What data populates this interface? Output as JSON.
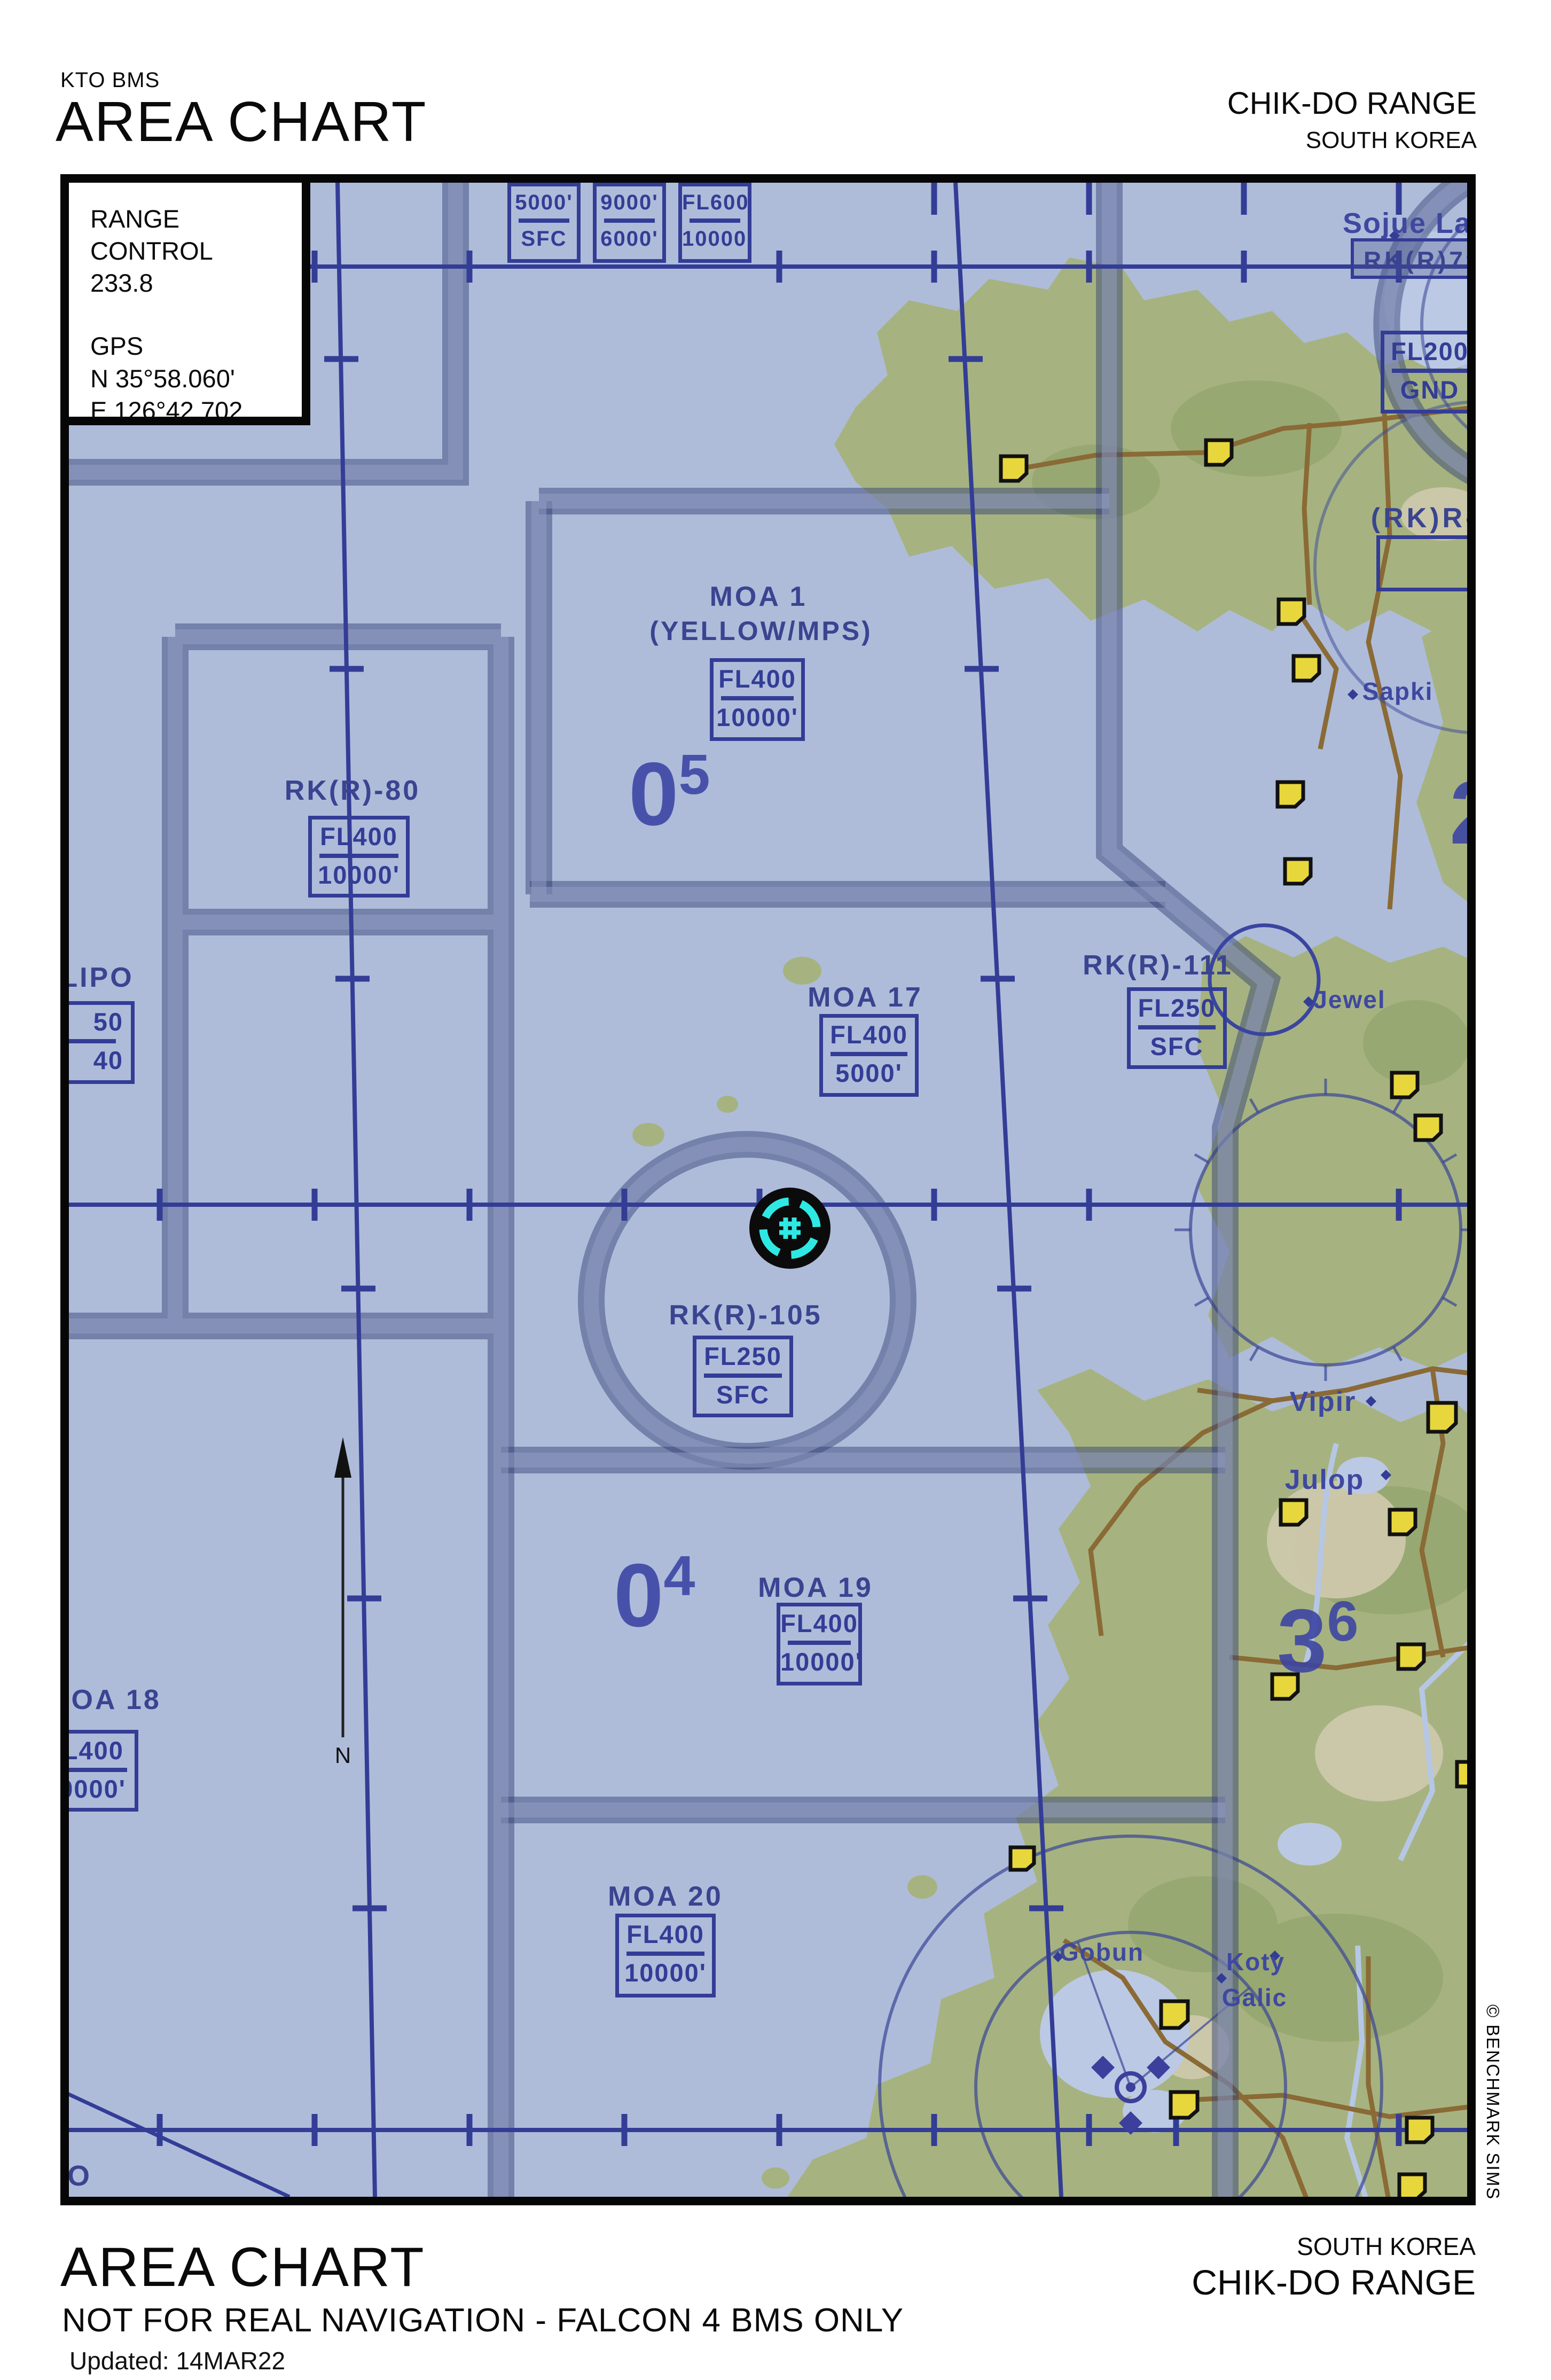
{
  "header": {
    "program": "KTO BMS",
    "title": "AREA CHART",
    "range": "CHIK-DO RANGE",
    "country": "SOUTH KOREA"
  },
  "info_box": {
    "title": "RANGE CONTROL",
    "frequency": "233.8",
    "gps_label": "GPS",
    "lat": "N 35°58.060'",
    "lon": "E  126°42.702"
  },
  "top_altitude_boxes": [
    {
      "upper": "5000'",
      "lower": "SFC"
    },
    {
      "upper": "9000'",
      "lower": "6000'"
    },
    {
      "upper": "FL600",
      "lower": "10000'"
    }
  ],
  "zones": {
    "moa1": {
      "name": "MOA 1",
      "sub": "(YELLOW/MPS)",
      "upper": "FL400",
      "lower": "10000'"
    },
    "moa17": {
      "name": "MOA 17",
      "upper": "FL400",
      "lower": "5000'"
    },
    "moa18": {
      "name": "MOA 18",
      "upper": "FL400",
      "lower": "10000'"
    },
    "moa19": {
      "name": "MOA 19",
      "upper": "FL400",
      "lower": "10000'"
    },
    "moa20": {
      "name": "MOA 20",
      "upper": "FL400",
      "lower": "10000'"
    },
    "rkr80": {
      "name": "RK(R)-80",
      "upper": "FL400",
      "lower": "10000'"
    },
    "rkr105": {
      "name": "RK(R)-105",
      "upper": "FL250",
      "lower": "SFC"
    },
    "rkr111": {
      "name": "RK(R)-111",
      "upper": "FL250",
      "lower": "SFC"
    },
    "rkr79": {
      "name": "(RK)R-79",
      "upper": "FL200",
      "lower": "GND"
    },
    "rkr79a": {
      "name": "RK(R)79A&"
    },
    "lipo": {
      "name": "LIPO",
      "upper": "50",
      "lower": "40"
    },
    "partial": "O"
  },
  "towns": {
    "sojue": "Sojue Lag",
    "sapki": "Sapki",
    "jewel": "Jewel",
    "vipir": "Vipir",
    "julop": "Julop",
    "gobun": "Gobun",
    "koty": "Koty",
    "galic": "Galic"
  },
  "grid_refs": {
    "r05": {
      "big": "0",
      "sup": "5"
    },
    "r04": {
      "big": "0",
      "sup": "4"
    },
    "r36": {
      "big": "3",
      "sup": "6"
    },
    "r2": {
      "big": "2",
      "sup": ""
    }
  },
  "compass": {
    "north": "N"
  },
  "footer": {
    "title": "AREA CHART",
    "disclaimer": "NOT FOR REAL NAVIGATION - FALCON 4 BMS ONLY",
    "updated": "Updated: 14MAR22",
    "country": "SOUTH KOREA",
    "range": "CHIK-DO RANGE"
  },
  "copyright": "© BENCHMARK SIMS",
  "colors": {
    "map_water": "#aebcda",
    "terrain": "#a6b380",
    "boundary_band": "#46508a",
    "grid_line": "#333d96",
    "label_navy": "#3a4490",
    "town_marker": "#e8d73c",
    "road": "#8a6a35",
    "target_cyan": "#2ee9e3"
  }
}
